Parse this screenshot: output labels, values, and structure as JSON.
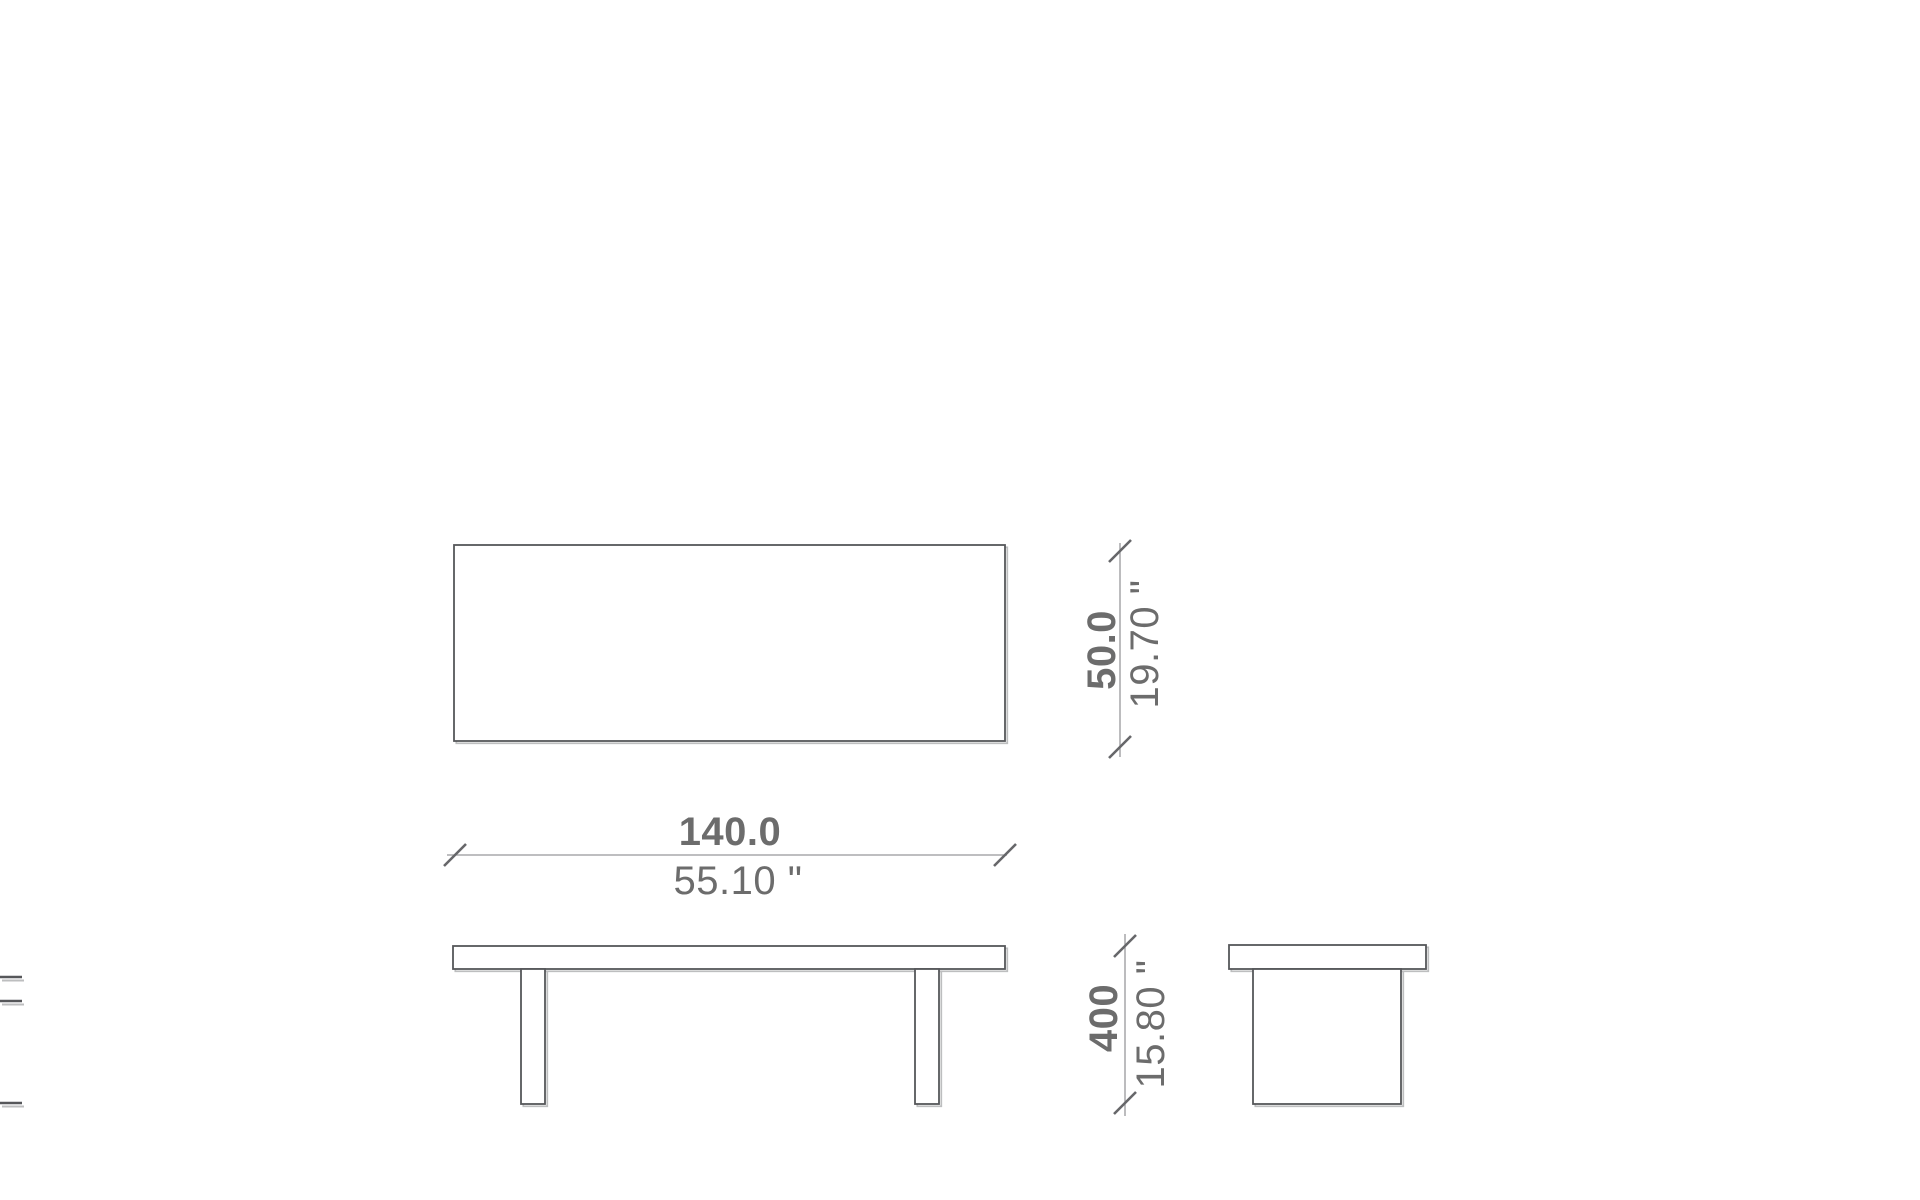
{
  "colors": {
    "background": "#ffffff",
    "line": "#56575a",
    "shadow": "#bdbebf",
    "dim-line": "#97989b",
    "tick": "#66676a",
    "text": "#6c6c6c"
  },
  "dimensions": {
    "width": {
      "metric": "140.0",
      "imperial": "55.10 \""
    },
    "depth": {
      "metric": "50.0",
      "imperial": "19.70 \""
    },
    "height": {
      "metric": "400",
      "imperial": "15.80 \""
    }
  }
}
